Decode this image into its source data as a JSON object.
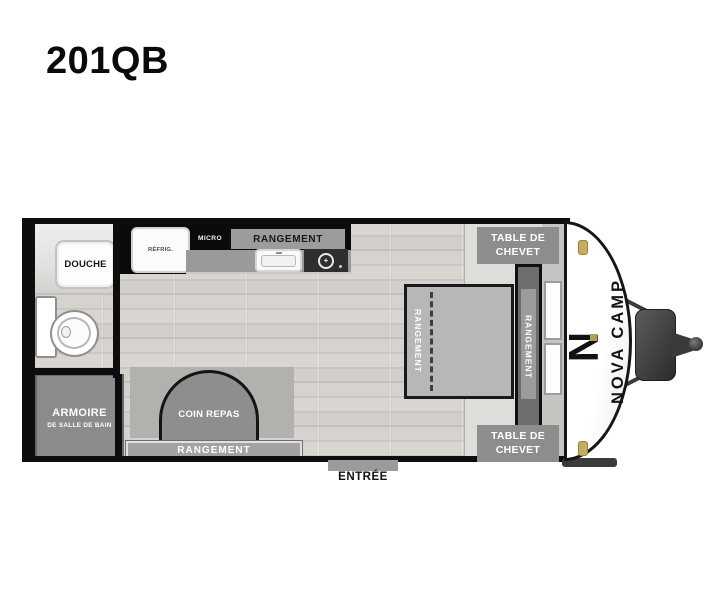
{
  "title": "201QB",
  "brand": {
    "name": "NOVA CAMP",
    "logo_letter": "N"
  },
  "labels": {
    "shower": "DOUCHE",
    "fridge": "RÉFRIG.",
    "microwave": "MICRO",
    "kitchen_storage": "RANGEMENT",
    "bathroom_cabinet_line1": "ARMOIRE",
    "bathroom_cabinet_line2": "DE SALLE DE BAIN",
    "dinette": "COIN REPAS",
    "dinette_storage": "RANGEMENT",
    "bed_storage": "RANGEMENT",
    "headboard_storage": "RANGEMENT",
    "nightstand_line1": "TABLE DE",
    "nightstand_line2": "CHEVET",
    "entrance": "ENTRÉE"
  },
  "colors": {
    "wall_black": "#0d0d0d",
    "cabinet_gray": "#8d8d8d",
    "floor_wood": "#d3d1cd",
    "bedroom_floor": "#dfddda",
    "accent_gold": "#c6ae5e",
    "cap_white": "#ffffff"
  }
}
